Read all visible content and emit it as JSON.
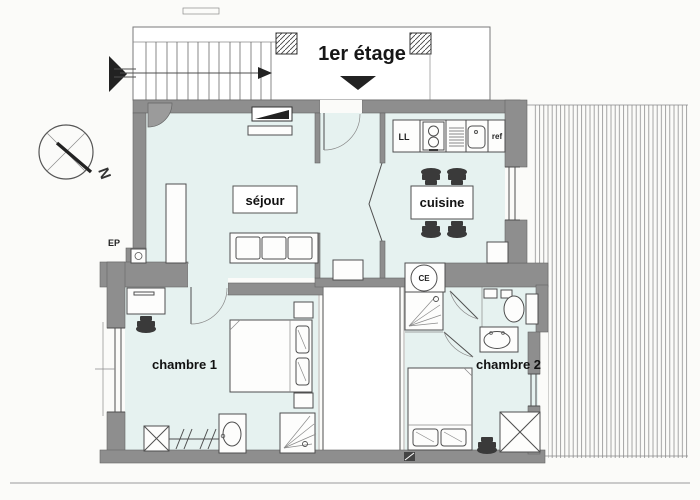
{
  "title": "1er étage",
  "compass": {
    "north_label": "N"
  },
  "rooms": {
    "living_room": {
      "label": "séjour"
    },
    "kitchen": {
      "label": "cuisine"
    },
    "bedroom1": {
      "label": "chambre 1"
    },
    "bedroom2": {
      "label": "chambre 2"
    }
  },
  "equipment_labels": {
    "washing_machine": "LL",
    "fridge": "ref",
    "water_heater": "CE",
    "rainwater_downpipe": "EP"
  },
  "colors": {
    "wall_gray": "#8e8e8e",
    "room_tint": "#e6f2f0",
    "line": "#4f4f4f",
    "furniture_dark": "#3a3a3a",
    "paper": "#fbfbf9"
  }
}
